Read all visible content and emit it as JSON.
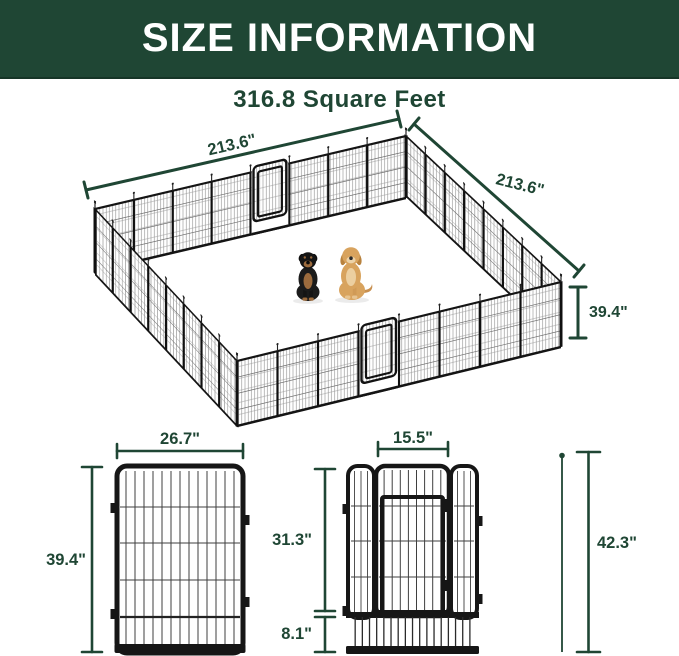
{
  "header": {
    "title": "SIZE INFORMATION"
  },
  "main_diagram": {
    "area_label": "316.8 Square Feet",
    "side_a_label": "213.6\"",
    "side_b_label": "213.6\"",
    "height_label": "39.4\"",
    "dogs": [
      "rottweiler",
      "golden retriever"
    ]
  },
  "panel_diagram": {
    "width_label": "26.7\"",
    "height_label": "39.4\""
  },
  "door_diagram": {
    "door_width_label": "15.5\"",
    "door_height_label": "31.3\"",
    "bottom_height_label": "8.1\"",
    "total_height_label": "42.3\""
  },
  "colors": {
    "banner_green": "#1F4634",
    "dimension_green": "#1F4634",
    "frame_black": "#161616",
    "rottweiler_coat": "#1b1b1b",
    "rottweiler_tan": "#9c6b3d",
    "golden_coat": "#d8a35e"
  }
}
